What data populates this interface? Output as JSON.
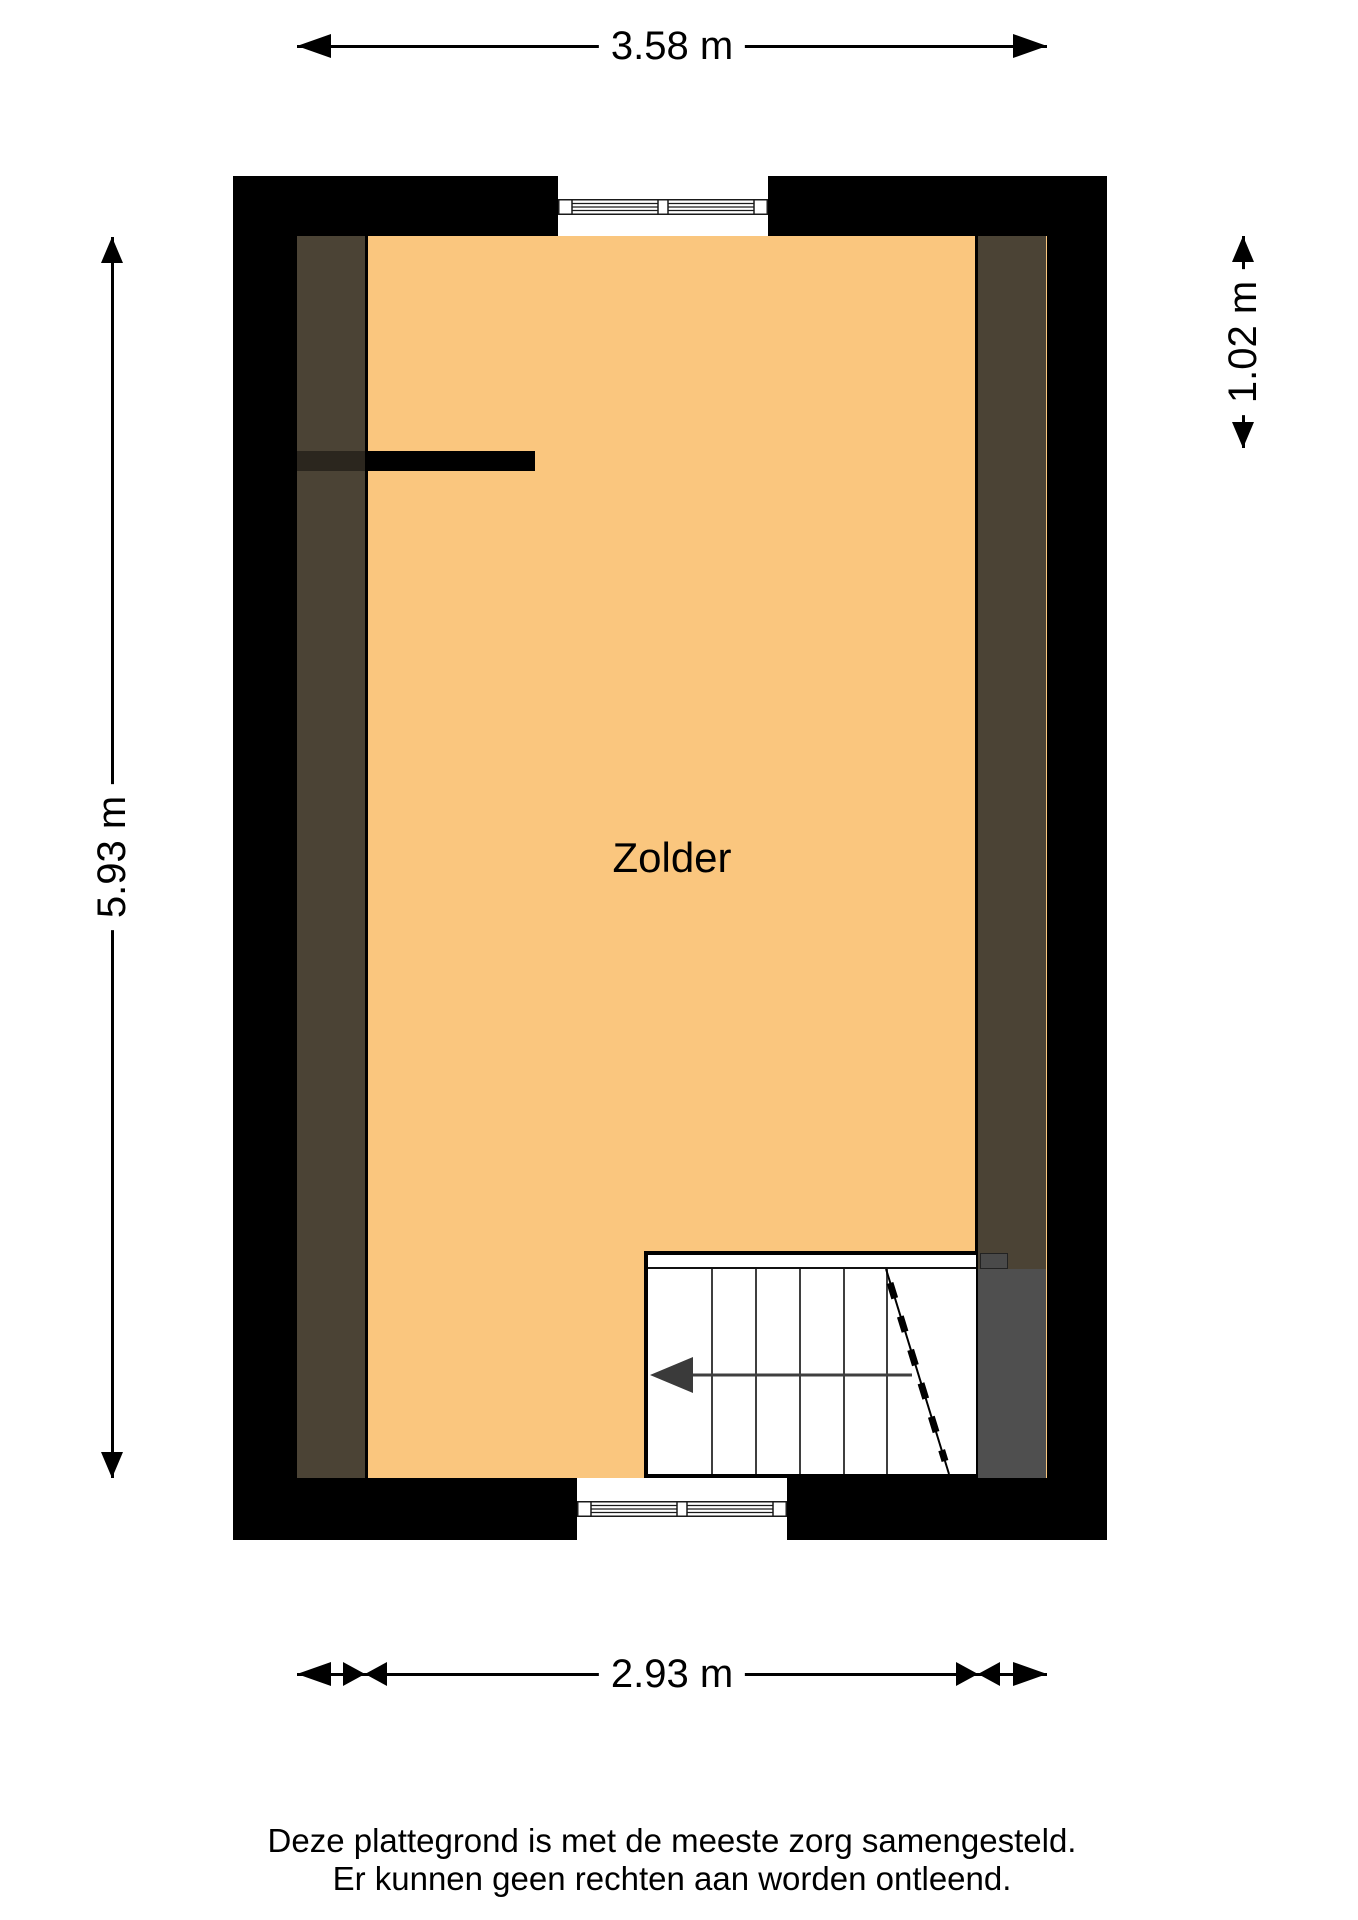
{
  "plan": {
    "room_label": "Zolder",
    "dimensions": {
      "top": "3.58 m",
      "left": "5.93 m",
      "right": "1.02 m",
      "bottom": "2.93 m"
    },
    "footer": {
      "line1": "Deze plattegrond is met de meeste zorg samengesteld.",
      "line2": "Er kunnen geen rechten aan worden ontleend."
    },
    "colors": {
      "floor": "#FAC67E",
      "eaves_overlay": "#4B4335",
      "wall": "#000000",
      "stair_void": "#4F4F4F",
      "dimension_ink": "#000000"
    }
  }
}
